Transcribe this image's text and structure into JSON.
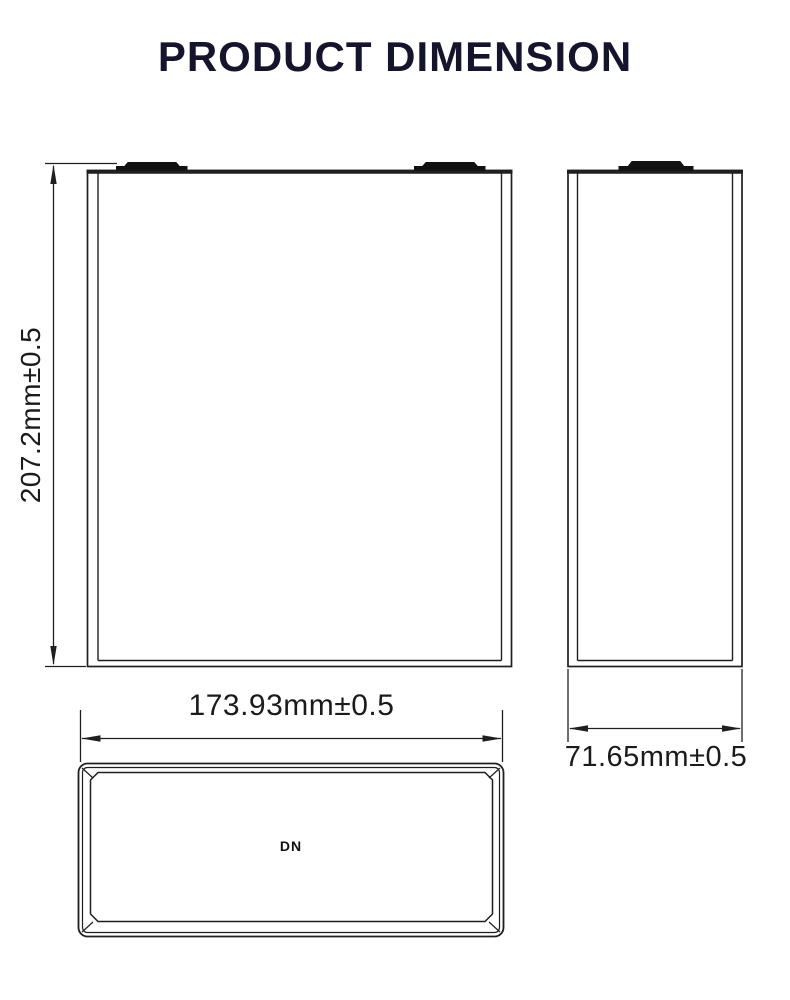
{
  "title": "PRODUCT DIMENSION",
  "drawing": {
    "front_view": {
      "height_dimension": "207.2mm±0.5"
    },
    "side_view": {
      "width_dimension": "71.65mm±0.5"
    },
    "top_view": {
      "length_dimension": "173.93mm±0.5",
      "vent_mark": "DN"
    }
  },
  "colors": {
    "title": "#14142d",
    "line": "#1f1f1f",
    "terminal": "#111111"
  }
}
